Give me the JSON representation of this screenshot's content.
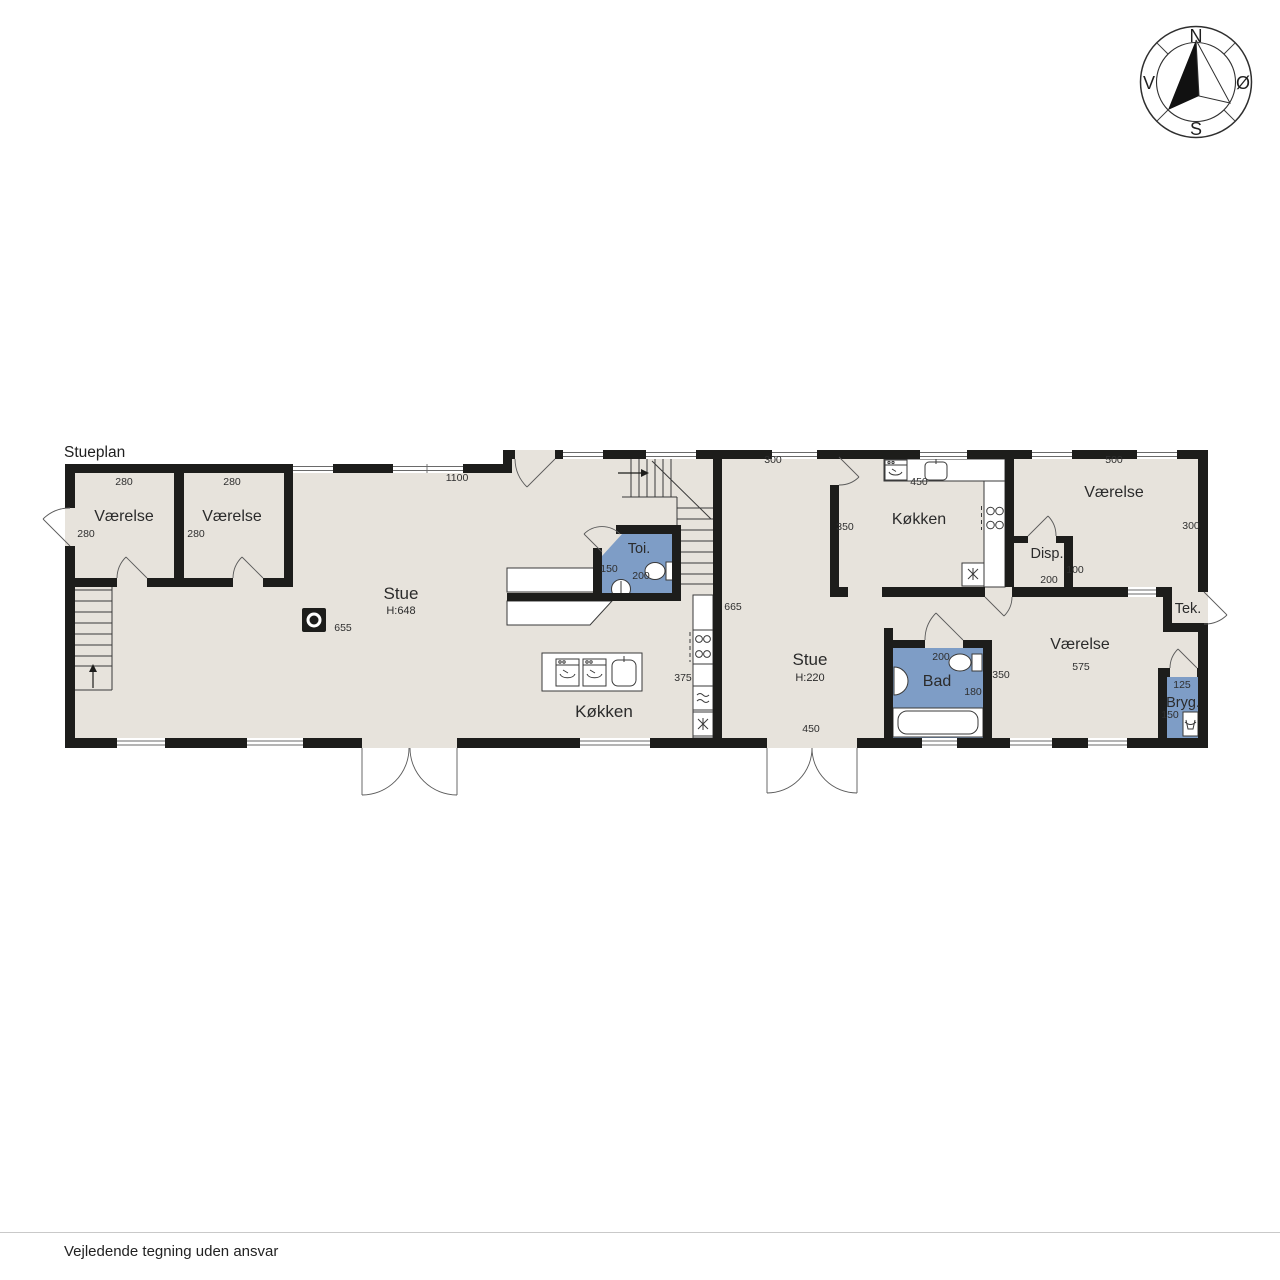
{
  "page": {
    "title": "Stueplan",
    "footer": "Vejledende tegning uden ansvar"
  },
  "compass": {
    "north": "N",
    "east": "Ø",
    "south": "S",
    "west": "V"
  },
  "colors": {
    "floor": "#e7e3dc",
    "wet_room": "#7e9dc6",
    "wall": "#1d1d1b"
  },
  "rooms": {
    "vaerelse_1": {
      "label": "Værelse",
      "width": "280",
      "depth": "280"
    },
    "vaerelse_2": {
      "label": "Værelse",
      "width": "280",
      "depth": "280"
    },
    "stue_1": {
      "label": "Stue",
      "ceiling": "H:648",
      "length": "1100",
      "right": "665",
      "stove": "655"
    },
    "koekken_1": {
      "label": "Køkken",
      "island": "375"
    },
    "toi": {
      "label": "Toi.",
      "w": "150",
      "d": "200"
    },
    "stue_2": {
      "label": "Stue",
      "ceiling": "H:220",
      "top": "300",
      "mid": "350",
      "bottom": "450"
    },
    "koekken_2": {
      "label": "Køkken",
      "counter": "450"
    },
    "vaerelse_3": {
      "label": "Værelse",
      "top": "500",
      "right": "300"
    },
    "disp": {
      "label": "Disp.",
      "right": "100",
      "bottom": "200"
    },
    "tek": {
      "label": "Tek."
    },
    "bad": {
      "label": "Bad",
      "top": "200",
      "right": "180",
      "hall": "350"
    },
    "vaerelse_4": {
      "label": "Værelse",
      "width": "575"
    },
    "bryg": {
      "label": "Bryg.",
      "top": "125",
      "left": "150"
    }
  }
}
